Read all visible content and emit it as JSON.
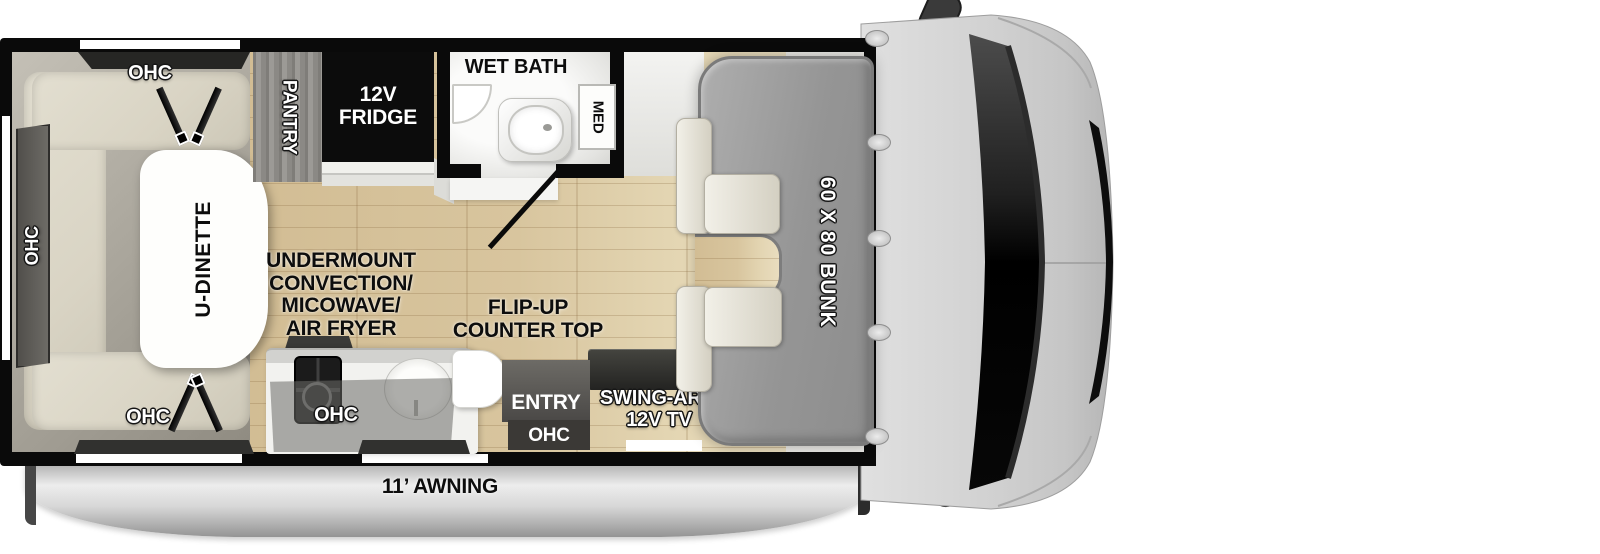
{
  "labels": {
    "ohc": "OHC",
    "pantry": "PANTRY",
    "fridge": "12V\nFRIDGE",
    "wet_bath": "WET BATH",
    "med": "MED",
    "u_dinette": "U-DINETTE",
    "undermount_appliance": "UNDERMOUNT\nCONVECTION/\nMICOWAVE/\nAIR FRYER",
    "flip_up_counter": "FLIP-UP\nCOUNTER TOP",
    "entry": "ENTRY",
    "swing_arm_tv": "SWING-ARM\n12V TV",
    "bunk": "60 X 80 BUNK",
    "awning": "11’ AWNING"
  },
  "colors": {
    "wall": "#0a0a0a",
    "floor_wood": "#d8c59e",
    "cushion": "#dcd7c7",
    "bunk_gray": "#9d9d9d",
    "cab_gray": "#cfcfcf",
    "awning_silver": "#d7d7d7",
    "cabinet_dark": "#3a3a38",
    "fixture_white": "#ffffff"
  }
}
